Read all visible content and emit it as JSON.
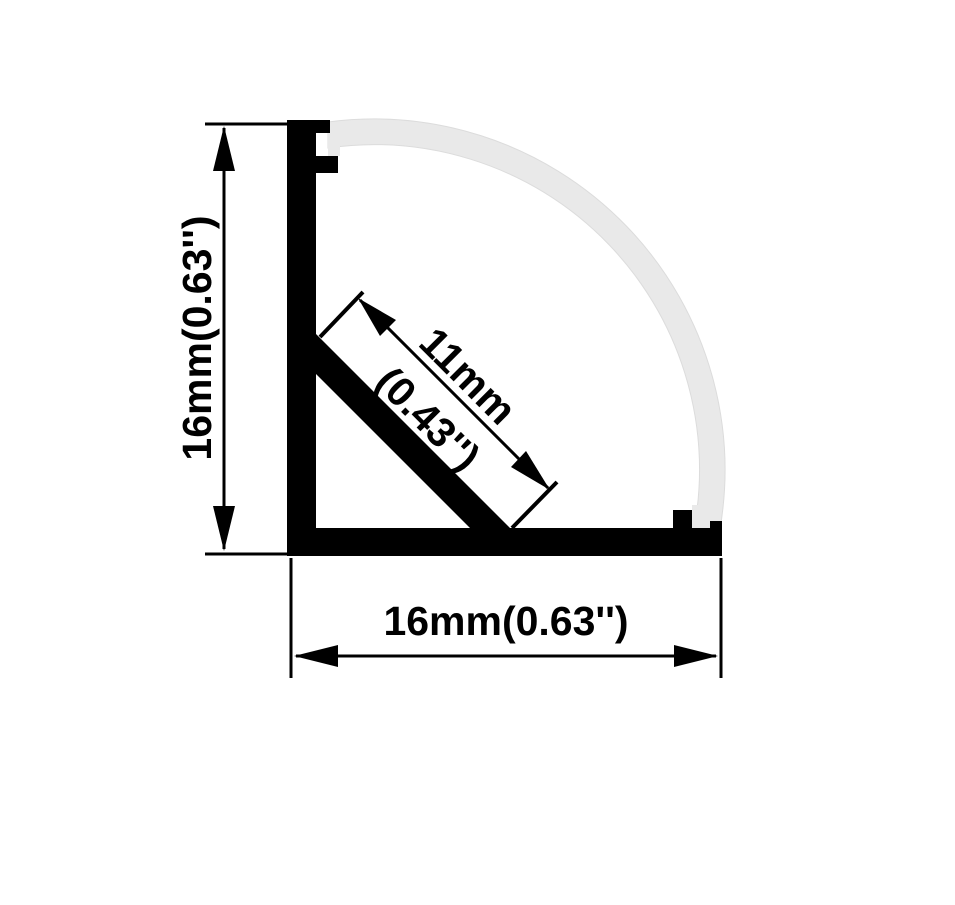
{
  "dimensions": {
    "vertical_label": "16mm(0.63'')",
    "horizontal_label": "16mm(0.63'')",
    "diagonal_label_value": "11mm",
    "diagonal_label_inches": "(0.43'')"
  },
  "colors": {
    "line": "#000000",
    "diffuser_fill": "#e9e9e9",
    "diffuser_edge": "#dcdcdc",
    "background": "#ffffff"
  }
}
